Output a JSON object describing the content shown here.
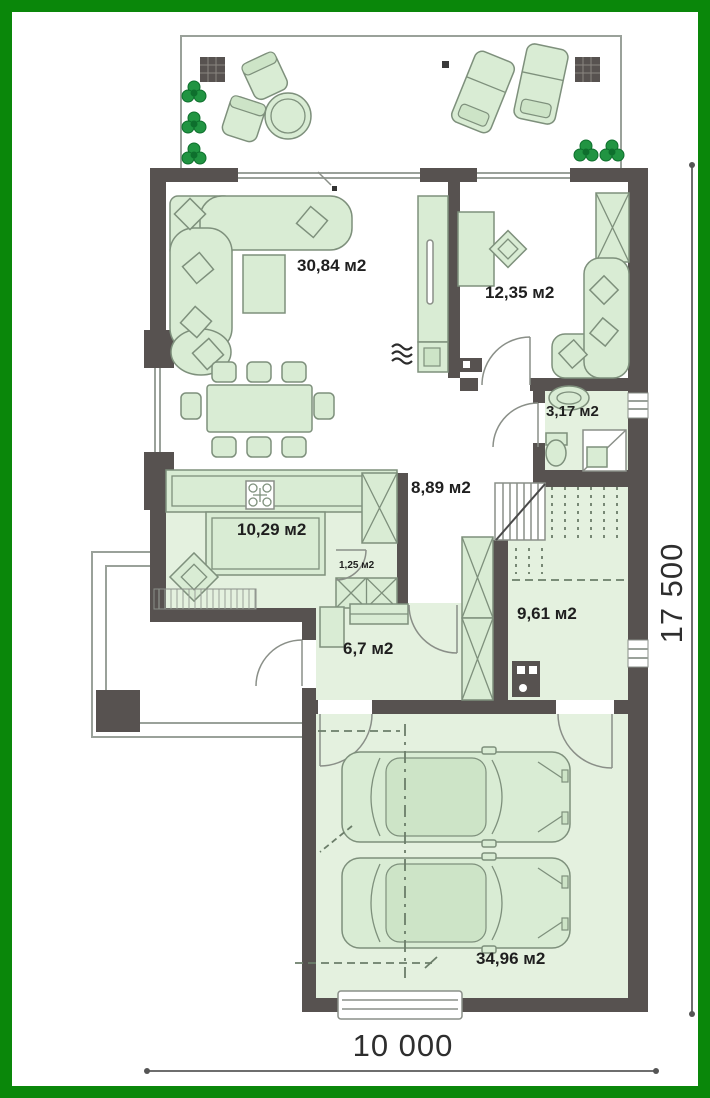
{
  "plan": {
    "type": "floor-plan-first-level",
    "rooms": {
      "living_room": {
        "area_label": "30,84 м2"
      },
      "bedroom": {
        "area_label": "12,35 м2"
      },
      "bathroom": {
        "area_label": "3,17 м2"
      },
      "hall": {
        "area_label": "8,89 м2"
      },
      "kitchen": {
        "area_label": "10,29 м2"
      },
      "pantry": {
        "area_label": "1,25 м2"
      },
      "entry_hall": {
        "area_label": "6,7 м2"
      },
      "utility_room": {
        "area_label": "9,61 м2"
      },
      "garage": {
        "area_label": "34,96 м2"
      }
    },
    "dimensions": {
      "overall_width_mm": "10 000",
      "overall_depth_mm": "17 500"
    },
    "colors": {
      "frame_green": "#0a870a",
      "wall_gray": "#575250",
      "furniture_fill": "#d9ecd4",
      "furniture_stroke": "#7e907c",
      "floor_tint": "#e4f1df",
      "bush_green": "#219442",
      "outline_gray": "#9aa19a",
      "text": "#1f1f1f"
    }
  }
}
